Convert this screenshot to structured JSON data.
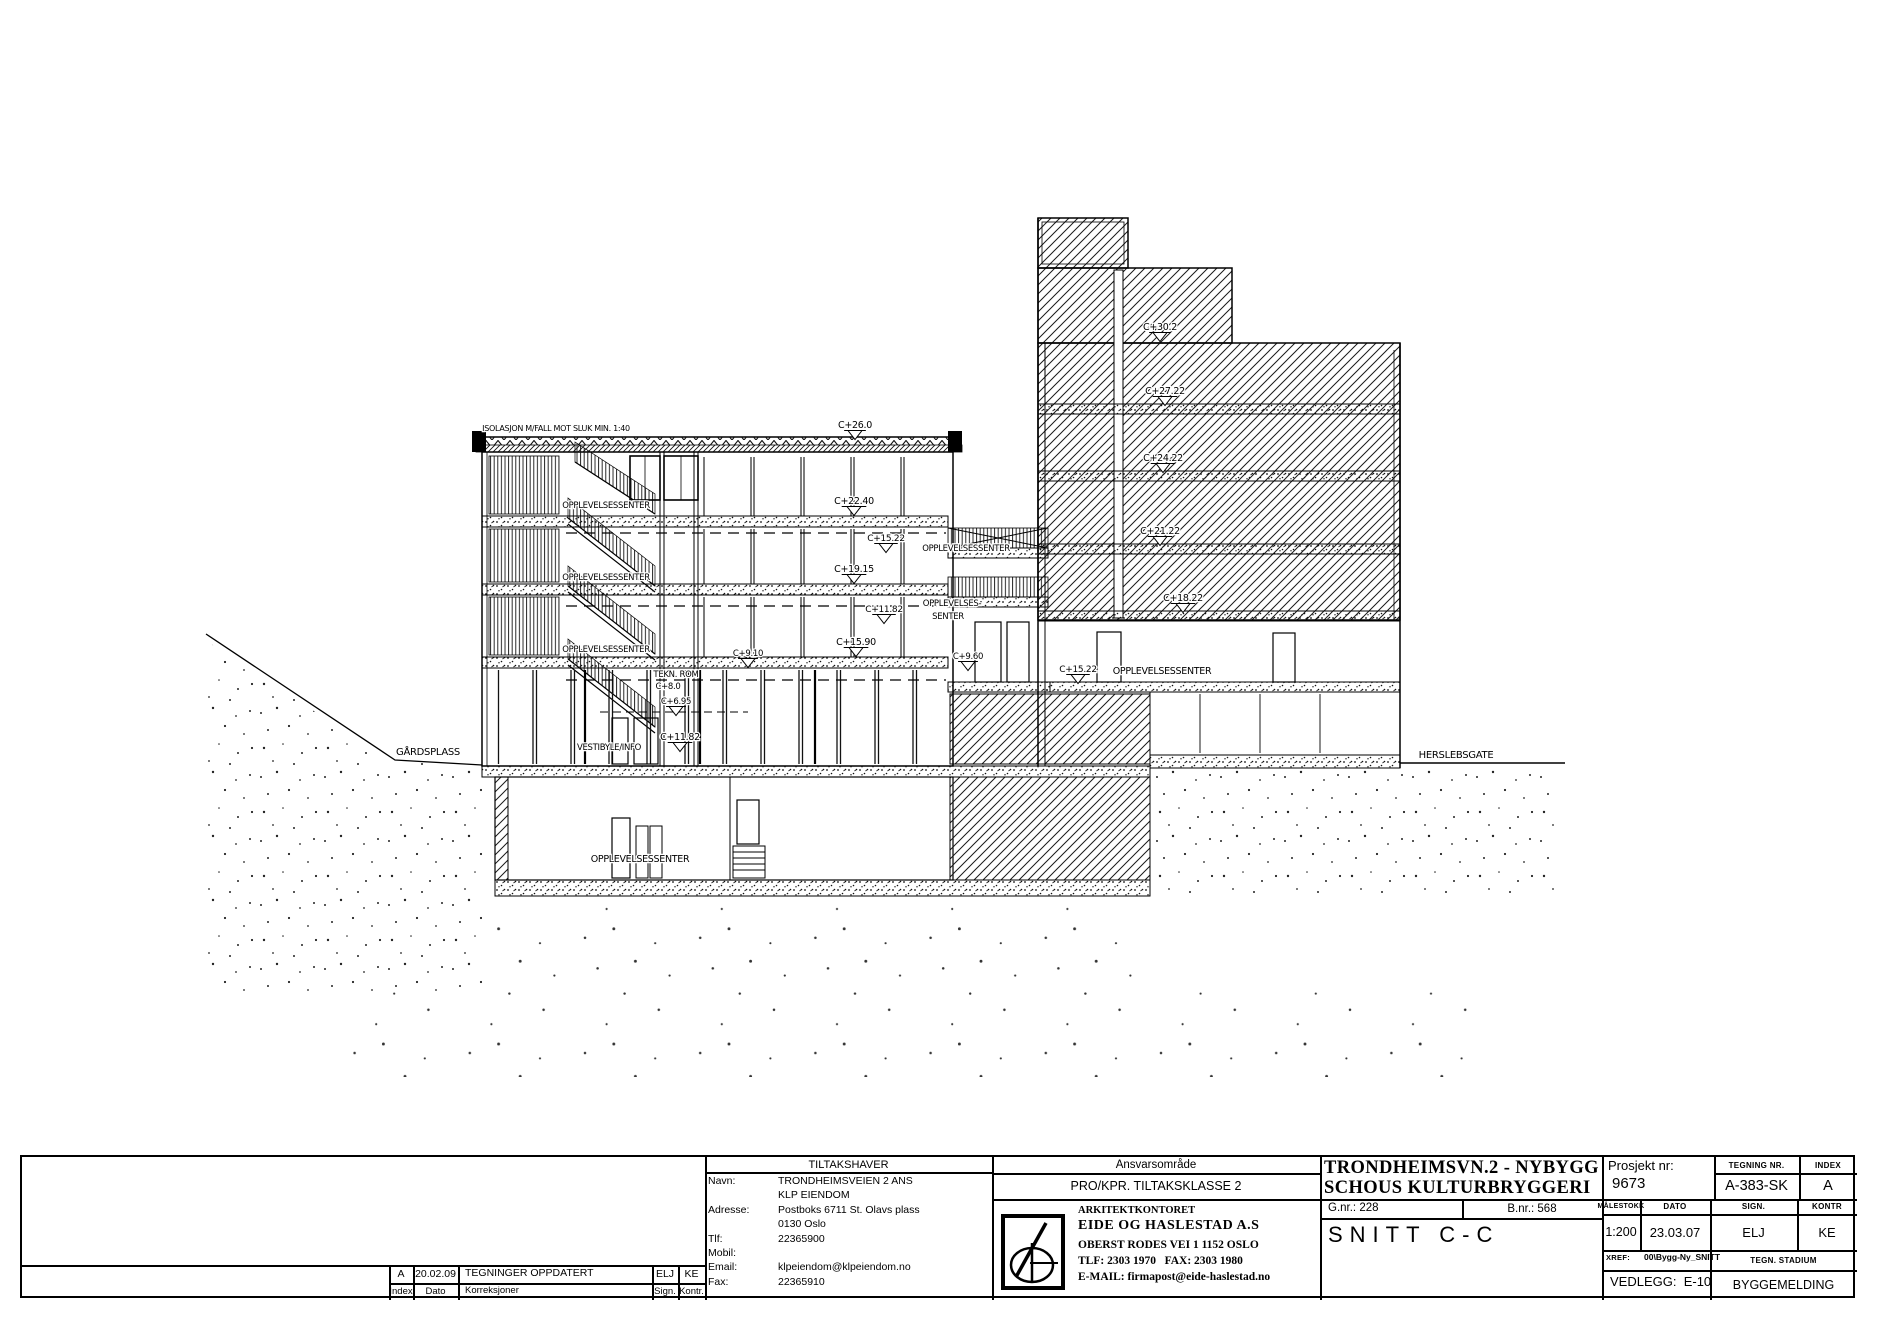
{
  "colors": {
    "paper": "#ffffff",
    "ink": "#000000"
  },
  "drawing": {
    "street_left": "GÅRDSPLASS",
    "street_right": "HERSLEBSGATE",
    "labels": [
      {
        "x": 556,
        "y": 431,
        "t": "ISOLASJON M/FALL MOT SLUK MIN. 1:40",
        "s": 8
      },
      {
        "x": 855,
        "y": 428,
        "t": "C+26.0",
        "s": 9.5,
        "m": 1
      },
      {
        "x": 854,
        "y": 504,
        "t": "C+22.40",
        "s": 9.5,
        "m": 1
      },
      {
        "x": 854,
        "y": 572,
        "t": "C+19.15",
        "s": 9.5,
        "m": 1
      },
      {
        "x": 856,
        "y": 645,
        "t": "C+15.90",
        "s": 9.5,
        "m": 1
      },
      {
        "x": 680,
        "y": 740,
        "t": "C+11.82",
        "s": 9.5,
        "m": 1
      },
      {
        "x": 748,
        "y": 656,
        "t": "C+9.10",
        "s": 8.5,
        "m": 1
      },
      {
        "x": 676,
        "y": 677,
        "t": "TEKN. ROM",
        "s": 8.5
      },
      {
        "x": 668,
        "y": 689,
        "t": "C+8.0",
        "s": 8.5
      },
      {
        "x": 676,
        "y": 704,
        "t": "C+6.95",
        "s": 8.5,
        "m": 1
      },
      {
        "x": 606,
        "y": 508,
        "t": "OPPLEVELSESSENTER",
        "s": 8.5
      },
      {
        "x": 606,
        "y": 580,
        "t": "OPPLEVELSESSENTER",
        "s": 8.5
      },
      {
        "x": 606,
        "y": 652,
        "t": "OPPLEVELSESSENTER",
        "s": 8.5
      },
      {
        "x": 609,
        "y": 750,
        "t": "VESTIBYLE/INFO",
        "s": 8.5
      },
      {
        "x": 640,
        "y": 862,
        "t": "OPPLEVELSESSENTER",
        "s": 9.5
      },
      {
        "x": 428,
        "y": 755,
        "t": "GÅRDSPLASS",
        "s": 10
      },
      {
        "x": 1456,
        "y": 758,
        "t": "HERSLEBSGATE",
        "s": 10
      },
      {
        "x": 886,
        "y": 541,
        "t": "C+15.22",
        "s": 9,
        "m": 1
      },
      {
        "x": 966,
        "y": 551,
        "t": "OPPLEVELSESSENTER",
        "s": 8.5
      },
      {
        "x": 884,
        "y": 612,
        "t": "C+11.82",
        "s": 9,
        "m": 1
      },
      {
        "x": 952,
        "y": 606,
        "t": "OPPLEVELSES-",
        "s": 8.5
      },
      {
        "x": 948,
        "y": 619,
        "t": "SENTER",
        "s": 8.5
      },
      {
        "x": 968,
        "y": 659,
        "t": "C+9.60",
        "s": 8.5,
        "m": 1
      },
      {
        "x": 1160,
        "y": 330,
        "t": "C+30.2",
        "s": 9.5,
        "m": 1
      },
      {
        "x": 1165,
        "y": 394,
        "t": "C+27.22",
        "s": 9.5,
        "m": 1
      },
      {
        "x": 1163,
        "y": 461,
        "t": "C+24.22",
        "s": 9.5,
        "m": 1
      },
      {
        "x": 1160,
        "y": 534,
        "t": "C+21.22",
        "s": 9.5,
        "m": 1
      },
      {
        "x": 1183,
        "y": 601,
        "t": "C+18.22",
        "s": 9.5,
        "m": 1
      },
      {
        "x": 1078,
        "y": 672,
        "t": "C+15.22",
        "s": 9,
        "m": 1
      },
      {
        "x": 1162,
        "y": 674,
        "t": "OPPLEVELSESSENTER",
        "s": 9.5
      }
    ]
  },
  "tb": {
    "rev": {
      "rows": [
        {
          "index": "A",
          "dato": "20.02.09",
          "korr": "TEGNINGER OPPDATERT",
          "sign": "ELJ",
          "kontr": "KE"
        }
      ],
      "foot": {
        "index": "Index",
        "dato": "Dato",
        "korr": "Korreksjoner",
        "sign": "Sign.",
        "kontr": "Kontr."
      }
    },
    "owner": {
      "header": "TILTAKSHAVER",
      "navn": "Navn:",
      "navn_v1": "TRONDHEIMSVEIEN 2 ANS",
      "navn_v2": "KLP EIENDOM",
      "adresse": "Adresse:",
      "adresse_v1": "Postboks 6711 St. Olavs plass",
      "adresse_v2": "0130 Oslo",
      "tlf": "Tlf:",
      "tlf_v": "22365900",
      "mobil": "Mobil:",
      "mobil_v": "",
      "email": "Email:",
      "email_v": "klpeiendom@klpeiendom.no",
      "fax": "Fax:",
      "fax_v": "22365910"
    },
    "ansvar": {
      "header": "Ansvarsområde",
      "row": "PRO/KPR. TILTAKSKLASSE 2",
      "firm_small": "ARKITEKTKONTORET",
      "firm": "EIDE OG HASLESTAD A.S",
      "addr": "OBERST RODES VEI 1 1152 OSLO",
      "tel": "TLF: 2303 1970   FAX: 2303 1980",
      "email": "E-MAIL: firmapost@eide-haslestad.no"
    },
    "project": {
      "title1": "TRONDHEIMSVN.2 - NYBYGG",
      "title2": "SCHOUS KULTURBRYGGERI",
      "gnr": "G.nr.: 228",
      "bnr": "B.nr.: 568",
      "drawing_title": "SNITT C-C",
      "prosjekt_label": "Prosjekt nr:",
      "prosjekt": "9673",
      "tegning_label": "TEGNING NR.",
      "tegning": "A-383-SK",
      "index_label": "INDEX",
      "index": "A",
      "malestokk_label": "MÅLESTOKK",
      "malestokk": "1:200",
      "dato_label": "DATO",
      "dato": "23.03.07",
      "sign_label": "SIGN.",
      "sign": "ELJ",
      "kontr_label": "KONTR",
      "kontr": "KE",
      "xref_label": "XREF:",
      "xref": "00\\Bygg-Ny_SNITT",
      "stadium_label": "TEGN. STADIUM",
      "vedlegg": "VEDLEGG:  E-10",
      "stadium": "BYGGEMELDING"
    }
  }
}
